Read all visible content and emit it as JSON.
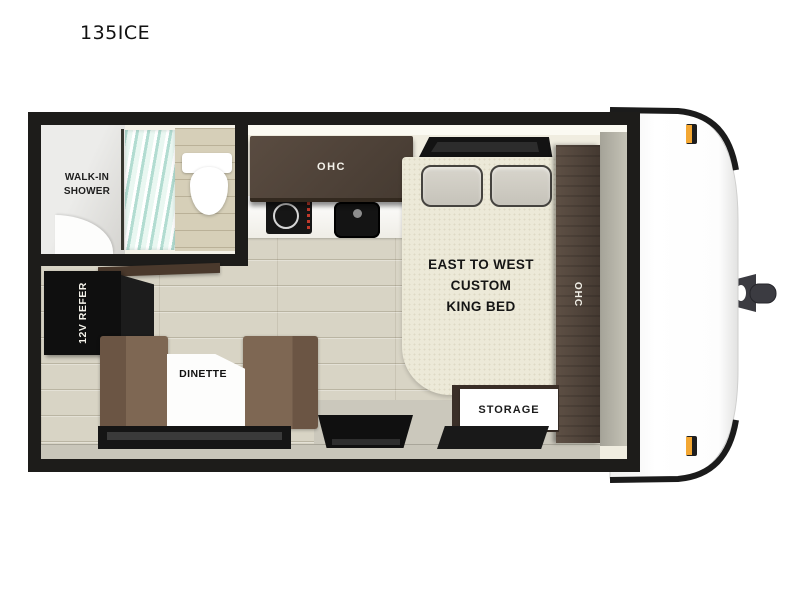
{
  "title": "135ICE",
  "floorplan": {
    "labels": {
      "shower": "WALK-IN\nSHOWER",
      "ohc_top": "OHC",
      "ohc_right": "OHC",
      "refrigerator": "12V REFER",
      "dinette": "DINETTE",
      "bed": "EAST TO WEST\nCUSTOM\nKING BED",
      "storage": "STORAGE"
    },
    "colors": {
      "wall_black": "#1d1c1a",
      "floor_plank": "#d8d4c5",
      "cabinet_wood": "#4e4136",
      "seat_brown": "#7b6450",
      "mattress_ivory": "#ece9d8",
      "marker_amber": "#f3a733",
      "shower_glass": "#b2dcd1",
      "cap_white": "#ffffff",
      "hitch_gray": "#3b3b41"
    }
  }
}
